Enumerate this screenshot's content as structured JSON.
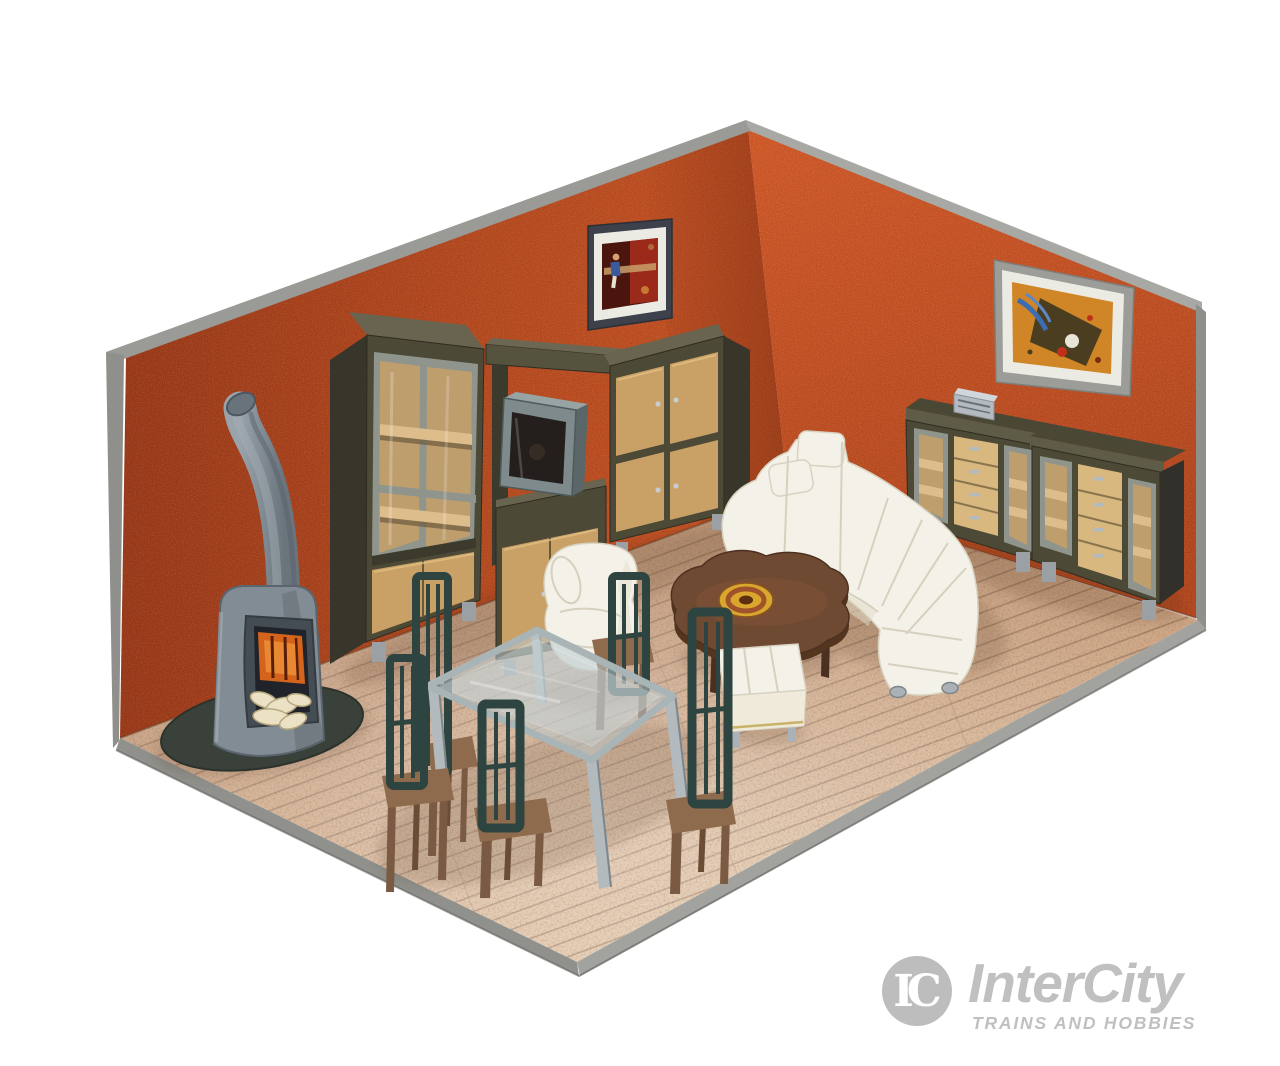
{
  "watermark": {
    "monogram": "IC",
    "brand": "InterCity",
    "tagline": "TRAINS AND HOBBIES"
  },
  "palette": {
    "wall_left": "#b04620",
    "wall_right": "#cc5326",
    "wall_edge": "#9a9a96",
    "floor_base": "#c49a7c",
    "plank_line": "#7f5c46",
    "base_rim": "#90908c",
    "cabinet_dark": "#4c4936",
    "cabinet_side": "#38362a",
    "cabinet_top": "#686450",
    "door_tan": "#c9a066",
    "shelf_beige": "#ddbd8b",
    "glass_frame": "#8f958c",
    "interior_beige": "#bf9e6e",
    "sofa_white": "#f4f1e8",
    "sofa_seam": "#d6d0be",
    "chair_teal": "#2d4440",
    "seat_brown": "#8f6b4e",
    "leg_brown": "#7a5a42",
    "table_glass": "#bcc9cc",
    "metal_silver": "#b2babe",
    "stove_gray": "#828c94",
    "stove_dark": "#575f66",
    "fire_orange": "#d4641c",
    "logs_cream": "#ebe2c6",
    "coffee_brown": "#6f4a32",
    "disc_gold": "#d9a62e",
    "picture_mat": "#ecebe3",
    "logo_gray": "#c0c0c0"
  },
  "scene": {
    "description": "Miniature model living-room furniture set staged in an open corner diorama with orange textured walls and a plank wood floor, photographed on white",
    "furniture": [
      "wood-burning stove with chimney pipe",
      "tall display cabinet with glass doors",
      "wall shelf",
      "television on lowboard",
      "wall cabinet with four tan doors",
      "framed picture on back wall",
      "framed picture on right wall",
      "two sideboards with glass panels and drawers",
      "small radio on sideboard",
      "white corner sofa with headrests",
      "white armchair",
      "white ottoman",
      "coffee table with round gold ornament",
      "glass dining table",
      "five high-back dining chairs"
    ]
  }
}
